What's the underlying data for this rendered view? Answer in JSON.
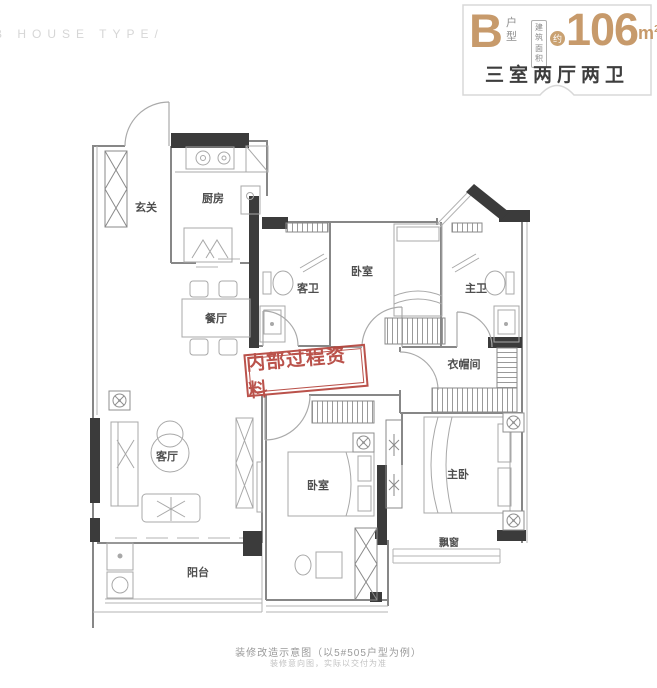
{
  "brand": {
    "text": "B HOUSE TYPE/"
  },
  "header": {
    "type_letter": "B",
    "type_chars": [
      "户",
      "型"
    ],
    "area_box_line1": "建筑",
    "area_box_line2": "面积",
    "approx": "约",
    "area_value": "106",
    "area_unit": "m",
    "area_sup": "2",
    "layout_summary": "三室两厅两卫",
    "accent_color": "#c79a6b",
    "summary_color": "#3d3d3d"
  },
  "watermark": {
    "text": "内部过程资料",
    "color": "#b5443c"
  },
  "rooms": {
    "entry": "玄关",
    "kitchen": "厨房",
    "dining": "餐厅",
    "guest_bath": "客卫",
    "bedroom_top": "卧室",
    "master_bath": "主卫",
    "closet": "衣帽间",
    "living": "客厅",
    "bedroom_bottom": "卧室",
    "master_bedroom": "主卧",
    "bay_window": "飘窗",
    "balcony": "阳台"
  },
  "footer": {
    "line1": "装修改造示意图（以5#505户型为例）",
    "line2": "装修意向图，实际以交付为准"
  },
  "plan_colors": {
    "wall": "#878787",
    "solid_wall": "#3b3b3b",
    "furniture": "#a8a8a8",
    "label": "#4e4e4e"
  }
}
